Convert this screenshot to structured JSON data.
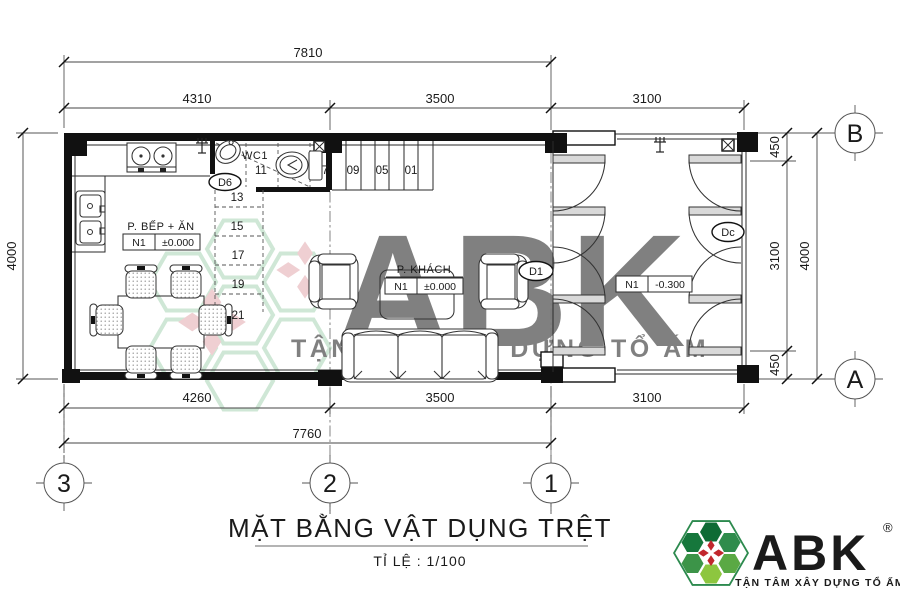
{
  "drawing": {
    "title": "MẶT BẰNG VẬT DỤNG TRỆT",
    "scale_label": "TỈ LỆ : 1/100"
  },
  "dimensions": {
    "top_total": "7810",
    "top_segments": [
      "4310",
      "3500",
      "3100"
    ],
    "bottom_segments": [
      "4260",
      "3500",
      "3100"
    ],
    "bottom_total": "7760",
    "left_total": "4000",
    "right_segments": [
      "450",
      "3100",
      "450"
    ],
    "right_total": "4000"
  },
  "grid": {
    "columns": [
      "3",
      "2",
      "1"
    ],
    "rows": [
      "B",
      "A"
    ]
  },
  "rooms": {
    "kitchen": {
      "name": "P.  BẾP + ĂN",
      "level_tag": "N1",
      "level_value": "±0.000"
    },
    "living": {
      "name": "P.    KHÁCH",
      "level_tag": "N1",
      "level_value": "±0.000"
    },
    "wc": {
      "name": "WC1"
    },
    "porch": {
      "level_tag": "N1",
      "level_value": "-0.300"
    }
  },
  "doors": {
    "wc_door": "D6",
    "living_door": "D1",
    "front_gate": "Dc"
  },
  "stairs": {
    "treads": [
      "01",
      "03",
      "05",
      "07",
      "09",
      "11",
      "13",
      "15",
      "17",
      "19",
      "21"
    ]
  },
  "watermark": {
    "text": "ABK",
    "slogan": "TẬN TÂM XÂY DỰNG TỔ ẤM"
  },
  "brand": {
    "name": "ABK",
    "registered": "®",
    "slogan": "TẬN TÂM XÂY DỰNG TỔ ẤM",
    "green": "#1e7a4b",
    "red": "#c1272d"
  },
  "colors": {
    "line": "#1a1a1a",
    "dim_text": "#1a1a1a",
    "watermark_teal": "#bedfda",
    "watermark_green": "#abd5b6",
    "watermark_pink": "#f0c3c7"
  }
}
